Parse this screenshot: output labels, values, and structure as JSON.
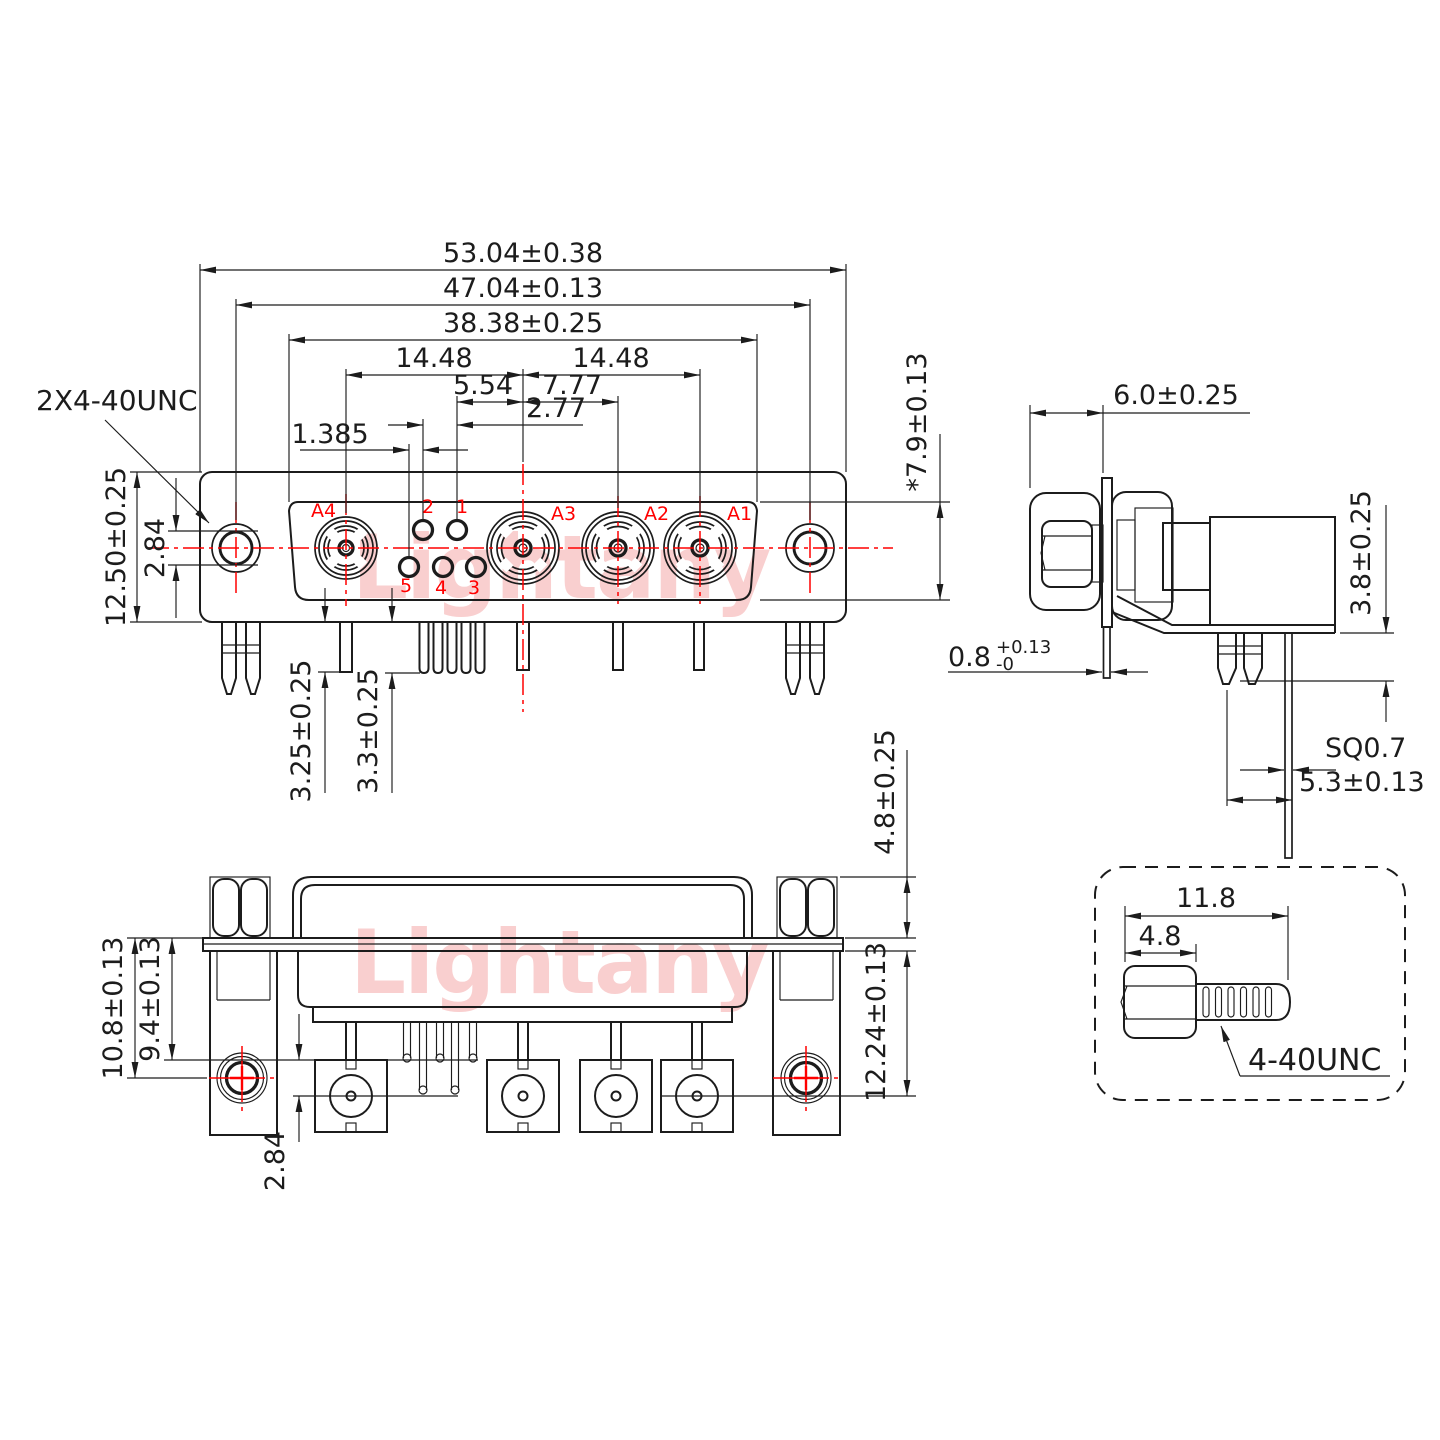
{
  "drawing": {
    "type": "connector engineering drawing",
    "colors": {
      "line": "#1c1c1c",
      "centerline_red": "#ff0000",
      "watermark_pink": "#f3a0a0"
    }
  },
  "watermark": {
    "text": "Lightany"
  },
  "front_view": {
    "thread_callout": "2X4-40UNC",
    "dim_53_04": "53.04±0.38",
    "dim_47_04": "47.04±0.13",
    "dim_38_38": "38.38±0.25",
    "dim_14_48_left": "14.48",
    "dim_14_48_right": "14.48",
    "dim_5_54": "5.54",
    "dim_7_77": "7.77",
    "dim_2_77": "2.77",
    "dim_1_385": "1.385",
    "dim_12_50": "12.50±0.25",
    "dim_2_84": "2.84",
    "dim_7_9": "*7.9±0.13",
    "dim_3_25": "3.25±0.25",
    "dim_3_3": "3.3±0.25",
    "contact_a4": "A4",
    "contact_a3": "A3",
    "contact_a2": "A2",
    "contact_a1": "A1",
    "pin_1": "1",
    "pin_2": "2",
    "pin_3": "3",
    "pin_4": "4",
    "pin_5": "5"
  },
  "side_view": {
    "dim_6_0": "6.0±0.25",
    "dim_3_8": "3.8±0.25",
    "dim_0_8_value": "0.8",
    "dim_0_8_plus": "+0.13",
    "dim_0_8_minus": "-0",
    "dim_sq": "SQ0.7",
    "dim_5_3": "5.3±0.13"
  },
  "bottom_view": {
    "dim_10_8": "10.8±0.13",
    "dim_9_4": "9.4±0.13",
    "dim_2_84": "2.84",
    "dim_4_8": "4.8±0.25",
    "dim_12_24": "12.24±0.13"
  },
  "screw_detail": {
    "dim_11_8": "11.8",
    "dim_4_8": "4.8",
    "thread_label": "4-40UNC"
  }
}
